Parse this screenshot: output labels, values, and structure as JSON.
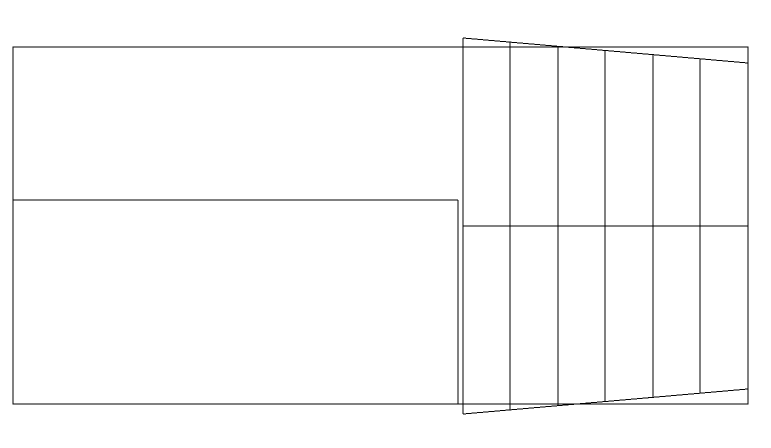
{
  "canvas": {
    "width": 771,
    "height": 448,
    "background_color": "#ffffff",
    "stroke_color": "#000000",
    "stroke_width": 1
  },
  "diagram": {
    "shapes": [
      {
        "name": "outer-rectangle",
        "type": "rect",
        "x": 13,
        "y": 47,
        "width": 735,
        "height": 357
      },
      {
        "name": "left-panel-mid-divider",
        "type": "line",
        "x1": 13,
        "y1": 200,
        "x2": 458,
        "y2": 200
      },
      {
        "name": "left-panel-right-edge",
        "type": "line",
        "x1": 458,
        "y1": 200,
        "x2": 458,
        "y2": 404
      },
      {
        "name": "taper-left-edge",
        "type": "line",
        "x1": 463,
        "y1": 38,
        "x2": 463,
        "y2": 414
      },
      {
        "name": "taper-top-edge",
        "type": "line",
        "x1": 463,
        "y1": 38,
        "x2": 748,
        "y2": 63
      },
      {
        "name": "taper-bottom-edge",
        "type": "line",
        "x1": 463,
        "y1": 414,
        "x2": 748,
        "y2": 389
      },
      {
        "name": "taper-mid-divider",
        "type": "line",
        "x1": 463,
        "y1": 226,
        "x2": 748,
        "y2": 226
      },
      {
        "name": "taper-vertical-1",
        "type": "line",
        "x1": 510,
        "y1": 42,
        "x2": 510,
        "y2": 410
      },
      {
        "name": "taper-vertical-2",
        "type": "line",
        "x1": 558,
        "y1": 46,
        "x2": 558,
        "y2": 406
      },
      {
        "name": "taper-vertical-3",
        "type": "line",
        "x1": 605,
        "y1": 51,
        "x2": 605,
        "y2": 401
      },
      {
        "name": "taper-vertical-4",
        "type": "line",
        "x1": 653,
        "y1": 55,
        "x2": 653,
        "y2": 397
      },
      {
        "name": "taper-vertical-5",
        "type": "line",
        "x1": 700,
        "y1": 59,
        "x2": 700,
        "y2": 393
      }
    ]
  }
}
